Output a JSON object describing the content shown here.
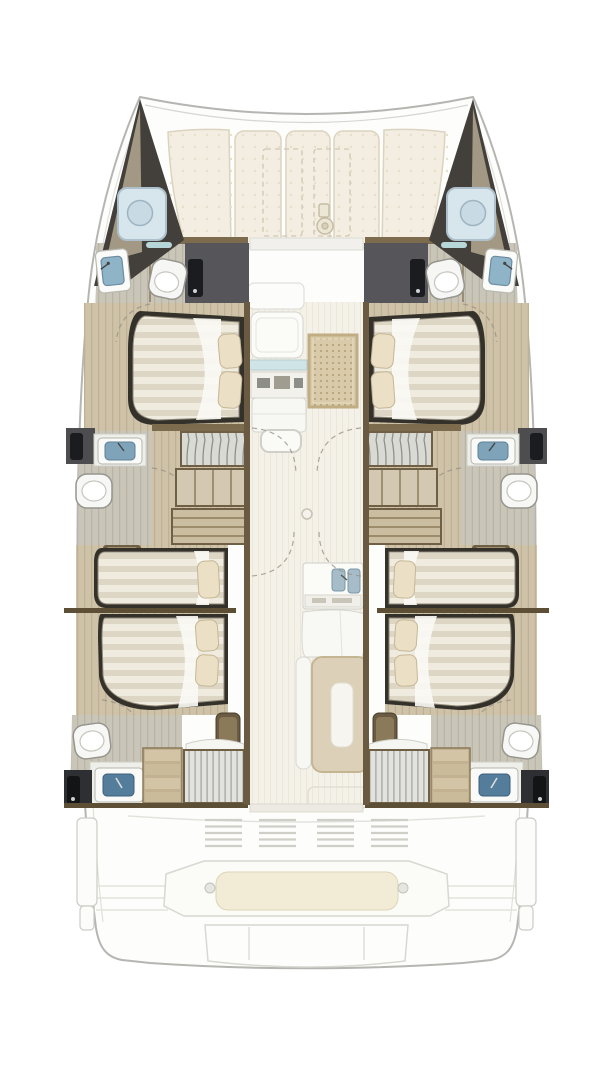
{
  "diagram": {
    "type": "floor-plan",
    "subject": "catamaran-yacht-interior-layout",
    "view": "top-down",
    "orientation": "bow-at-top",
    "symmetry": "port-and-starboard-hulls-mirrored",
    "text_labels": []
  },
  "colors": {
    "background": "#ffffff",
    "hull_outline": "#b5b5b1",
    "hull_inner_line": "#e0e0db",
    "deck_cushion": "#f3eee1",
    "cushion_edge": "#dbd3bf",
    "cabin_floor_wood": "#cec2a8",
    "bathroom_floor": "#c9c5b8",
    "salon_floor": "#f4f1e8",
    "wood_trim": "#6b5a3d",
    "wood_beam": "#7d6b4e",
    "bed_frame": "#34312b",
    "mattress_base": "#f0ebdf",
    "mattress_stripe": "#ded6c4",
    "sheet_white": "#faf9f4",
    "pillow": "#ebdfc5",
    "dark_door_panel": "#56565a",
    "door_leaf_black": "#1b1c1f",
    "bow_locker_dark": "#43403b",
    "bow_locker_taupe": "#a39884",
    "skylight_glass": "#d7e5ed",
    "sink_basin_blue": "#8fb3c7",
    "aft_basin_blue": "#547c9b",
    "rug": "#d9caa9",
    "rug_dot": "#b7a47c",
    "island_table": "#dcd1b8",
    "bench_cushion": "#f2ecd6",
    "shower_stripe": "#a2a29c",
    "deck_line": "#e3e3de"
  },
  "foredeck": {
    "cushion_panels": 5,
    "sunpad_outlines": 2,
    "icons": [
      "windlass-icon"
    ]
  },
  "nacelle": {
    "fixtures": [
      "coachroof-front",
      "forward-seat",
      "glass-band",
      "nav-console",
      "storage-cabinet",
      "storage-tray",
      "area-rug",
      "salon-floor",
      "floor-hatch",
      "galley-counter",
      "double-sink",
      "galley-sofa",
      "island-table",
      "island-bench",
      "aft-sliding-door"
    ]
  },
  "port_hull": {
    "rooms": [
      {
        "name": "bow-locker",
        "fixtures": [
          "deck-skylight"
        ]
      },
      {
        "name": "forward-head",
        "fixtures": [
          "vanity-sink",
          "toilet",
          "dark-door-panel"
        ]
      },
      {
        "name": "forward-double-cabin",
        "fixtures": [
          "island-double-bed",
          "pillows"
        ]
      },
      {
        "name": "mid-head",
        "fixtures": [
          "vanity-sink",
          "toilet",
          "dark-door-panel"
        ]
      },
      {
        "name": "wardrobe-area",
        "fixtures": [
          "hanging-locker",
          "shelf-unit",
          "companionway-stairs"
        ]
      },
      {
        "name": "single-berth-cabin",
        "fixtures": [
          "single-berth",
          "pillow",
          "head-shelf"
        ]
      },
      {
        "name": "aft-double-cabin",
        "fixtures": [
          "double-bed",
          "pillows",
          "step-pouf"
        ]
      },
      {
        "name": "aft-head",
        "fixtures": [
          "toilet",
          "vanity-sink",
          "shower",
          "stairs",
          "black-door-panel"
        ]
      }
    ]
  },
  "starboard_hull": {
    "mirrored_from": "port_hull"
  },
  "aft_deck": {
    "fixtures": [
      "vent-grilles",
      "stern-bench",
      "bench-cushion",
      "grab-knobs",
      "transom-steps",
      "swim-platform",
      "stern-fins"
    ]
  },
  "fixture_counts": {
    "double_beds": 4,
    "single_berths": 2,
    "toilets": 6,
    "hull_wash_basins": 6,
    "galley_sinks": 2,
    "showers": 2,
    "skylights": 2,
    "staircases": 4
  }
}
